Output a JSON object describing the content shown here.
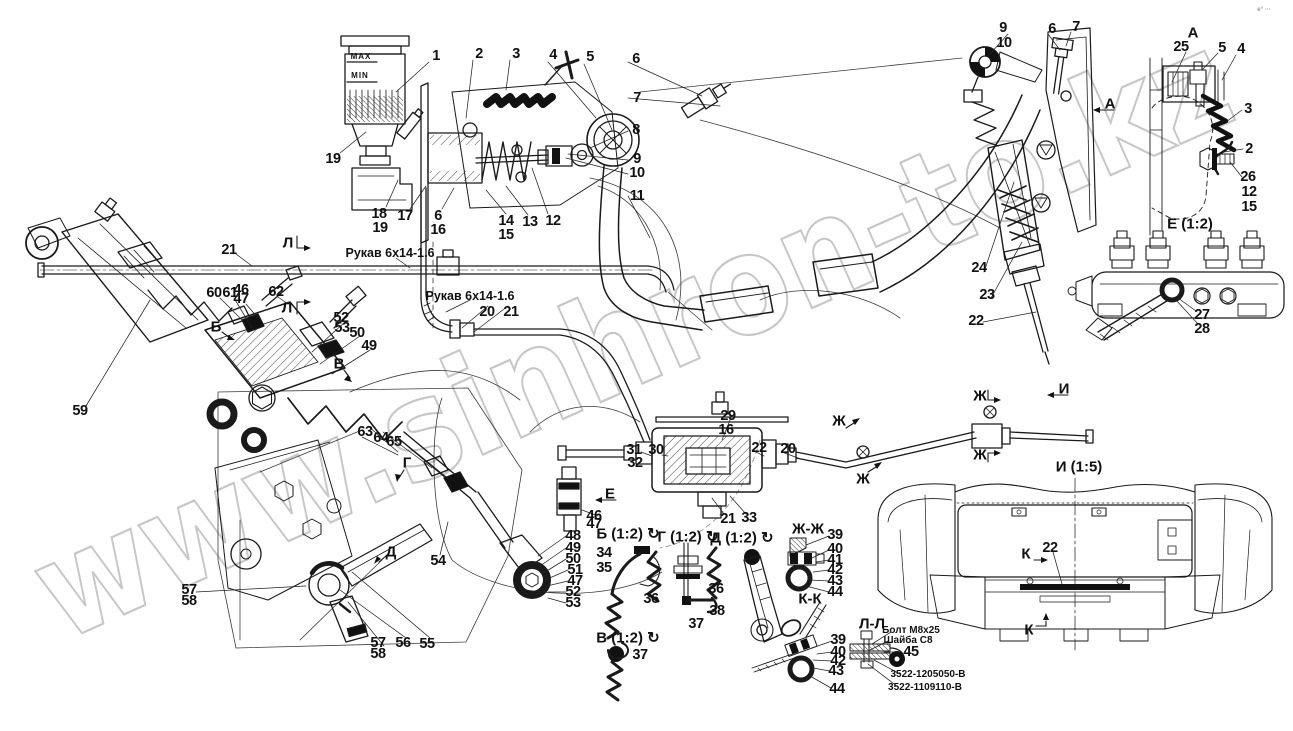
{
  "drawing": {
    "type": "parts-diagram",
    "watermark": {
      "text": "www.sinhron-to.kz",
      "color": "#c7c7c7"
    },
    "line_color": "#1a1a1a",
    "background": "#ffffff"
  },
  "annotations": [
    {
      "n": "callout-1",
      "t": "1",
      "x": 436,
      "y": 56,
      "c": "co"
    },
    {
      "n": "callout-2",
      "t": "2",
      "x": 479,
      "y": 54,
      "c": "co"
    },
    {
      "n": "callout-3",
      "t": "3",
      "x": 516,
      "y": 54,
      "c": "co"
    },
    {
      "n": "callout-4",
      "t": "4",
      "x": 553,
      "y": 55,
      "c": "co"
    },
    {
      "n": "callout-5",
      "t": "5",
      "x": 590,
      "y": 57,
      "c": "co"
    },
    {
      "n": "callout-6",
      "t": "6",
      "x": 636,
      "y": 59,
      "c": "co"
    },
    {
      "n": "callout-7",
      "t": "7",
      "x": 637,
      "y": 98,
      "c": "co"
    },
    {
      "n": "callout-8",
      "t": "8",
      "x": 636,
      "y": 130,
      "c": "co"
    },
    {
      "n": "callout-9",
      "t": "9",
      "x": 637,
      "y": 159,
      "c": "co"
    },
    {
      "n": "callout-10",
      "t": "10",
      "x": 637,
      "y": 173,
      "c": "co"
    },
    {
      "n": "callout-11",
      "t": "11",
      "x": 637,
      "y": 196,
      "c": "co"
    },
    {
      "n": "callout-19",
      "t": "19",
      "x": 333,
      "y": 159,
      "c": "co"
    },
    {
      "n": "callout-18",
      "t": "18",
      "x": 379,
      "y": 214,
      "c": "co"
    },
    {
      "n": "callout-19b",
      "t": "19",
      "x": 380,
      "y": 228,
      "c": "co"
    },
    {
      "n": "callout-17",
      "t": "17",
      "x": 405,
      "y": 216,
      "c": "co"
    },
    {
      "n": "callout-6b",
      "t": "6",
      "x": 438,
      "y": 216,
      "c": "co"
    },
    {
      "n": "callout-16",
      "t": "16",
      "x": 438,
      "y": 230,
      "c": "co"
    },
    {
      "n": "callout-14",
      "t": "14",
      "x": 506,
      "y": 221,
      "c": "co"
    },
    {
      "n": "callout-15",
      "t": "15",
      "x": 506,
      "y": 235,
      "c": "co"
    },
    {
      "n": "callout-13",
      "t": "13",
      "x": 530,
      "y": 222,
      "c": "co"
    },
    {
      "n": "callout-12",
      "t": "12",
      "x": 553,
      "y": 221,
      "c": "co"
    },
    {
      "n": "callout-9r",
      "t": "9",
      "x": 1003,
      "y": 28,
      "c": "co"
    },
    {
      "n": "callout-10r",
      "t": "10",
      "x": 1004,
      "y": 43,
      "c": "co"
    },
    {
      "n": "callout-6r",
      "t": "6",
      "x": 1052,
      "y": 29,
      "c": "co"
    },
    {
      "n": "callout-7r",
      "t": "7",
      "x": 1076,
      "y": 27,
      "c": "co"
    },
    {
      "n": "callout-25",
      "t": "25",
      "x": 1181,
      "y": 47,
      "c": "co"
    },
    {
      "n": "callout-5r",
      "t": "5",
      "x": 1222,
      "y": 48,
      "c": "co"
    },
    {
      "n": "callout-4r",
      "t": "4",
      "x": 1241,
      "y": 49,
      "c": "co"
    },
    {
      "n": "callout-3r",
      "t": "3",
      "x": 1248,
      "y": 109,
      "c": "co"
    },
    {
      "n": "callout-2r",
      "t": "2",
      "x": 1249,
      "y": 149,
      "c": "co"
    },
    {
      "n": "callout-26",
      "t": "26",
      "x": 1248,
      "y": 177,
      "c": "co"
    },
    {
      "n": "callout-12r",
      "t": "12",
      "x": 1249,
      "y": 192,
      "c": "co"
    },
    {
      "n": "callout-15r",
      "t": "15",
      "x": 1249,
      "y": 207,
      "c": "co"
    },
    {
      "n": "callout-27",
      "t": "27",
      "x": 1202,
      "y": 315,
      "c": "co"
    },
    {
      "n": "callout-28",
      "t": "28",
      "x": 1202,
      "y": 329,
      "c": "co"
    },
    {
      "n": "callout-21",
      "t": "21",
      "x": 229,
      "y": 250,
      "c": "co"
    },
    {
      "n": "callout-60",
      "t": "60",
      "x": 214,
      "y": 293,
      "c": "co"
    },
    {
      "n": "callout-61",
      "t": "61",
      "x": 230,
      "y": 293,
      "c": "co"
    },
    {
      "n": "callout-46",
      "t": "46",
      "x": 241,
      "y": 290,
      "c": "co"
    },
    {
      "n": "callout-47",
      "t": "47",
      "x": 241,
      "y": 299,
      "c": "co"
    },
    {
      "n": "callout-62",
      "t": "62",
      "x": 276,
      "y": 292,
      "c": "co"
    },
    {
      "n": "callout-52",
      "t": "52",
      "x": 341,
      "y": 318,
      "c": "co"
    },
    {
      "n": "callout-53",
      "t": "53",
      "x": 342,
      "y": 328,
      "c": "co"
    },
    {
      "n": "callout-50",
      "t": "50",
      "x": 357,
      "y": 333,
      "c": "co"
    },
    {
      "n": "callout-49",
      "t": "49",
      "x": 369,
      "y": 346,
      "c": "co"
    },
    {
      "n": "callout-20",
      "t": "20",
      "x": 487,
      "y": 312,
      "c": "co"
    },
    {
      "n": "callout-21b",
      "t": "21",
      "x": 511,
      "y": 312,
      "c": "co"
    },
    {
      "n": "callout-59",
      "t": "59",
      "x": 80,
      "y": 411,
      "c": "co"
    },
    {
      "n": "callout-63",
      "t": "63",
      "x": 365,
      "y": 432,
      "c": "co"
    },
    {
      "n": "callout-64",
      "t": "64",
      "x": 381,
      "y": 438,
      "c": "co"
    },
    {
      "n": "callout-65",
      "t": "65",
      "x": 394,
      "y": 442,
      "c": "co"
    },
    {
      "n": "callout-54",
      "t": "54",
      "x": 438,
      "y": 561,
      "c": "co"
    },
    {
      "n": "callout-48",
      "t": "48",
      "x": 573,
      "y": 536,
      "c": "co"
    },
    {
      "n": "callout-49b",
      "t": "49",
      "x": 573,
      "y": 548,
      "c": "co"
    },
    {
      "n": "callout-50b",
      "t": "50",
      "x": 573,
      "y": 559,
      "c": "co"
    },
    {
      "n": "callout-51",
      "t": "51",
      "x": 575,
      "y": 570,
      "c": "co"
    },
    {
      "n": "callout-47b",
      "t": "47",
      "x": 575,
      "y": 581,
      "c": "co"
    },
    {
      "n": "callout-52b",
      "t": "52",
      "x": 573,
      "y": 592,
      "c": "co"
    },
    {
      "n": "callout-53b",
      "t": "53",
      "x": 573,
      "y": 603,
      "c": "co"
    },
    {
      "n": "callout-57",
      "t": "57",
      "x": 189,
      "y": 590,
      "c": "co"
    },
    {
      "n": "callout-58",
      "t": "58",
      "x": 189,
      "y": 601,
      "c": "co"
    },
    {
      "n": "callout-57b",
      "t": "57",
      "x": 378,
      "y": 643,
      "c": "co"
    },
    {
      "n": "callout-58b",
      "t": "58",
      "x": 378,
      "y": 654,
      "c": "co"
    },
    {
      "n": "callout-56",
      "t": "56",
      "x": 403,
      "y": 643,
      "c": "co"
    },
    {
      "n": "callout-55",
      "t": "55",
      "x": 427,
      "y": 644,
      "c": "co"
    },
    {
      "n": "callout-29",
      "t": "29",
      "x": 728,
      "y": 416,
      "c": "co"
    },
    {
      "n": "callout-16c",
      "t": "16",
      "x": 726,
      "y": 430,
      "c": "co"
    },
    {
      "n": "callout-31",
      "t": "31",
      "x": 634,
      "y": 450,
      "c": "co"
    },
    {
      "n": "callout-32",
      "t": "32",
      "x": 635,
      "y": 463,
      "c": "co"
    },
    {
      "n": "callout-30",
      "t": "30",
      "x": 656,
      "y": 450,
      "c": "co"
    },
    {
      "n": "callout-22c",
      "t": "22",
      "x": 759,
      "y": 448,
      "c": "co"
    },
    {
      "n": "callout-20c",
      "t": "20",
      "x": 788,
      "y": 449,
      "c": "co"
    },
    {
      "n": "callout-46b",
      "t": "46",
      "x": 594,
      "y": 516,
      "c": "co"
    },
    {
      "n": "callout-47c",
      "t": "47",
      "x": 594,
      "y": 524,
      "c": "co"
    },
    {
      "n": "callout-21c",
      "t": "21",
      "x": 728,
      "y": 519,
      "c": "co"
    },
    {
      "n": "callout-33",
      "t": "33",
      "x": 749,
      "y": 518,
      "c": "co"
    },
    {
      "n": "callout-34",
      "t": "34",
      "x": 604,
      "y": 553,
      "c": "co"
    },
    {
      "n": "callout-35",
      "t": "35",
      "x": 604,
      "y": 568,
      "c": "co"
    },
    {
      "n": "callout-36",
      "t": "36",
      "x": 651,
      "y": 599,
      "c": "co"
    },
    {
      "n": "callout-36b",
      "t": "36",
      "x": 716,
      "y": 589,
      "c": "co"
    },
    {
      "n": "callout-38",
      "t": "38",
      "x": 717,
      "y": 611,
      "c": "co"
    },
    {
      "n": "callout-37",
      "t": "37",
      "x": 696,
      "y": 624,
      "c": "co"
    },
    {
      "n": "callout-37b",
      "t": "37",
      "x": 640,
      "y": 655,
      "c": "co"
    },
    {
      "n": "callout-39",
      "t": "39",
      "x": 835,
      "y": 535,
      "c": "co"
    },
    {
      "n": "callout-40",
      "t": "40",
      "x": 835,
      "y": 549,
      "c": "co"
    },
    {
      "n": "callout-41",
      "t": "41",
      "x": 835,
      "y": 560,
      "c": "co"
    },
    {
      "n": "callout-42",
      "t": "42",
      "x": 835,
      "y": 570,
      "c": "co"
    },
    {
      "n": "callout-43",
      "t": "43",
      "x": 835,
      "y": 581,
      "c": "co"
    },
    {
      "n": "callout-44",
      "t": "44",
      "x": 835,
      "y": 592,
      "c": "co"
    },
    {
      "n": "callout-39b",
      "t": "39",
      "x": 838,
      "y": 640,
      "c": "co"
    },
    {
      "n": "callout-40b",
      "t": "40",
      "x": 838,
      "y": 652,
      "c": "co"
    },
    {
      "n": "callout-42b",
      "t": "42",
      "x": 838,
      "y": 661,
      "c": "co"
    },
    {
      "n": "callout-43b",
      "t": "43",
      "x": 836,
      "y": 671,
      "c": "co"
    },
    {
      "n": "callout-44b",
      "t": "44",
      "x": 837,
      "y": 689,
      "c": "co"
    },
    {
      "n": "callout-45",
      "t": "45",
      "x": 911,
      "y": 652,
      "c": "co"
    },
    {
      "n": "callout-24",
      "t": "24",
      "x": 979,
      "y": 268,
      "c": "co"
    },
    {
      "n": "callout-23",
      "t": "23",
      "x": 987,
      "y": 295,
      "c": "co"
    },
    {
      "n": "callout-22r",
      "t": "22",
      "x": 976,
      "y": 321,
      "c": "co"
    },
    {
      "n": "callout-22k",
      "t": "22",
      "x": 1050,
      "y": 548,
      "c": "co"
    },
    {
      "n": "view-title-a",
      "t": "А",
      "x": 1193,
      "y": 33,
      "c": "vt"
    },
    {
      "n": "view-title-e12",
      "t": "Е (1:2)",
      "x": 1190,
      "y": 224,
      "c": "vt"
    },
    {
      "n": "view-title-i15",
      "t": "И (1:5)",
      "x": 1079,
      "y": 467,
      "c": "vt"
    },
    {
      "n": "view-title-zhzh",
      "t": "Ж-Ж",
      "x": 808,
      "y": 529,
      "c": "vt"
    },
    {
      "n": "view-title-kk",
      "t": "К-К",
      "x": 810,
      "y": 599,
      "c": "vt"
    },
    {
      "n": "view-title-ll",
      "t": "Л-Л",
      "x": 872,
      "y": 624,
      "c": "vt"
    },
    {
      "n": "view-title-b12",
      "t": "Б (1:2) ↻",
      "x": 628,
      "y": 534,
      "c": "vt"
    },
    {
      "n": "view-title-g12",
      "t": "Г (1:2) ↻",
      "x": 688,
      "y": 537,
      "c": "vt"
    },
    {
      "n": "view-title-d12",
      "t": "Д (1:2) ↻",
      "x": 742,
      "y": 538,
      "c": "vt"
    },
    {
      "n": "view-title-v12",
      "t": "В (1:2) ↻",
      "x": 628,
      "y": 638,
      "c": "vt"
    },
    {
      "n": "section-mark-l1",
      "t": "Л",
      "x": 288,
      "y": 243,
      "c": "sm"
    },
    {
      "n": "section-mark-l2",
      "t": "Л",
      "x": 287,
      "y": 308,
      "c": "sm"
    },
    {
      "n": "section-mark-a",
      "t": "А",
      "x": 1110,
      "y": 104,
      "c": "sm"
    },
    {
      "n": "section-mark-b",
      "t": "Б",
      "x": 216,
      "y": 327,
      "c": "sm"
    },
    {
      "n": "section-mark-v",
      "t": "В",
      "x": 339,
      "y": 364,
      "c": "sm"
    },
    {
      "n": "section-mark-g",
      "t": "Г",
      "x": 407,
      "y": 463,
      "c": "sm"
    },
    {
      "n": "section-mark-d",
      "t": "Д",
      "x": 391,
      "y": 552,
      "c": "sm"
    },
    {
      "n": "section-mark-e",
      "t": "Е",
      "x": 610,
      "y": 494,
      "c": "sm"
    },
    {
      "n": "section-mark-zh1",
      "t": "Ж",
      "x": 839,
      "y": 421,
      "c": "sm"
    },
    {
      "n": "section-mark-zh2",
      "t": "Ж",
      "x": 863,
      "y": 479,
      "c": "sm"
    },
    {
      "n": "section-mark-zh3",
      "t": "Ж",
      "x": 980,
      "y": 396,
      "c": "sm"
    },
    {
      "n": "section-mark-zh4",
      "t": "Ж",
      "x": 980,
      "y": 455,
      "c": "sm"
    },
    {
      "n": "section-mark-i",
      "t": "И",
      "x": 1064,
      "y": 389,
      "c": "sm"
    },
    {
      "n": "section-mark-k1",
      "t": "К",
      "x": 1026,
      "y": 554,
      "c": "sm"
    },
    {
      "n": "section-mark-k2",
      "t": "К",
      "x": 1029,
      "y": 630,
      "c": "sm"
    },
    {
      "n": "hose-label-1",
      "t": "Рукав 6х14-1.6",
      "x": 390,
      "y": 253,
      "c": "lbl"
    },
    {
      "n": "hose-label-2",
      "t": "Рукав 6х14-1.6",
      "x": 470,
      "y": 296,
      "c": "lbl"
    },
    {
      "n": "bolt-label",
      "t": "Болт М8х25",
      "x": 911,
      "y": 631,
      "c": "tiny"
    },
    {
      "n": "washer-label",
      "t": "Шайба С8",
      "x": 908,
      "y": 641,
      "c": "tiny"
    },
    {
      "n": "part-number-1",
      "t": "3522-1205050-В",
      "x": 928,
      "y": 675,
      "c": "tiny"
    },
    {
      "n": "part-number-2",
      "t": "3522-1109110-В",
      "x": 925,
      "y": 688,
      "c": "tiny"
    },
    {
      "n": "reservoir-max",
      "t": "MAX",
      "x": 361,
      "y": 57,
      "c": "mm"
    },
    {
      "n": "reservoir-min",
      "t": "MIN",
      "x": 360,
      "y": 76,
      "c": "mm"
    },
    {
      "n": "corner-mark",
      "t": "е° ···",
      "x": 1264,
      "y": 10,
      "c": "corner"
    }
  ]
}
